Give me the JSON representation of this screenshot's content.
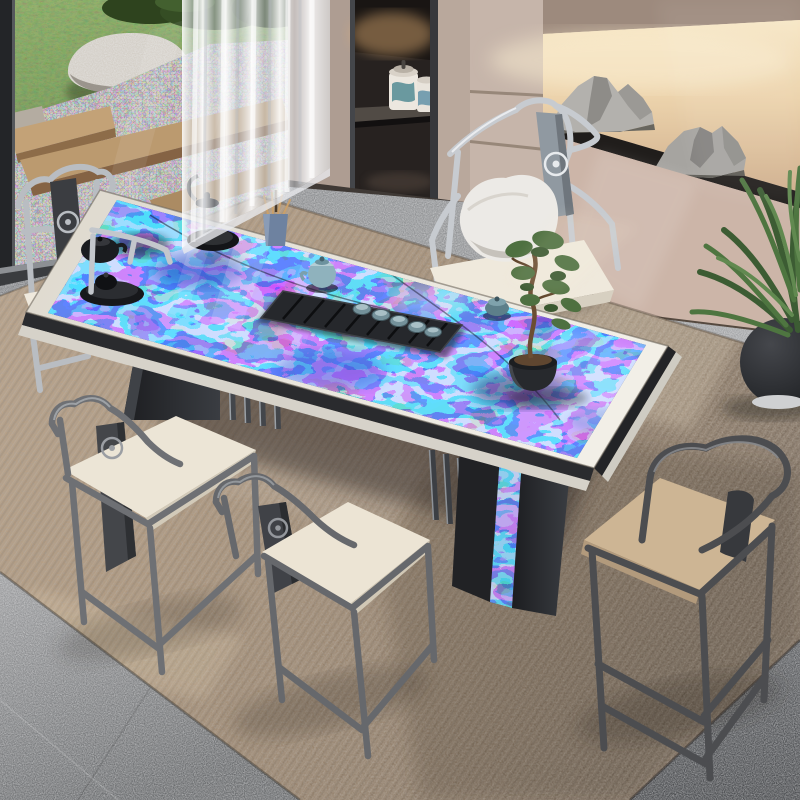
{
  "scene": {
    "title": "Sunlit modern Chinese tea room: labradorite blue-stone tea table with five gunmetal armchairs, sheer curtain, garden window, backlit rock niche and taupe cabinet",
    "window_garden": {
      "grass_color": "#6f8a4c",
      "boulder_color": "#cfc9c0",
      "gravel_color": "#97918b",
      "step_plank_color": "#bf9e74",
      "shrub_color": "#32481f"
    },
    "glazing_frame_color": "#222427",
    "curtain": {
      "type": "sheer-vertical-folds",
      "color": "#f4f5f7"
    },
    "cabinet": {
      "body_color": "#b7a69a",
      "niche_color": "#292320",
      "accent_light_color": "#e7b377",
      "tea_caddies": [
        {
          "body": "#ece7df",
          "motif": "#3f7f8a"
        },
        {
          "body": "#e9e4dc",
          "motif": "#46829c"
        }
      ]
    },
    "stone_niche": {
      "backlight_color": "#f3e0bf",
      "shelf_color": "#1f1d1b",
      "rock_sculpture_color": "#a8a6a2",
      "wall_color": "#c9b2a5"
    },
    "floor": {
      "tile_color": "#8e9092",
      "tile_shadow_color": "#5c5e60",
      "carpet_color": "#b09a80",
      "carpet_shadow_color": "#7e6f60"
    },
    "plant": {
      "foliage_color": "#44643a",
      "pot_color": "#26282b"
    },
    "table": {
      "top_material": "blue labradorite stone",
      "stone_colors": [
        "#2c4bb4",
        "#7d95d8",
        "#1b2550",
        "#9aa2b4",
        "#e2e6ee",
        "#15171b",
        "#b98f4a"
      ],
      "band_color": "#e8e4db",
      "apron_color": "#27282b",
      "leg_color": "#232428",
      "leg_detail": "vertical slat screen + labradorite edge inlay"
    },
    "tea_set": {
      "tray_color": "#202225",
      "tray_teapot_color": "#8fb2bd",
      "cup_color": "#74919a",
      "kettle_glass_color": "#d8dee3",
      "kettle_lid_color": "#0f1114",
      "stove_color": "#17191c",
      "black_teapot_color": "#1a1c1f",
      "gaiwan_color": "#5d7f8a",
      "tool_vase_color": "#6e82a0",
      "bonsai_pot_color": "#27292d",
      "bonsai_foliage_color": "#4e7040"
    },
    "chairs": [
      {
        "id": "back-left",
        "frame": "#b9bdc2",
        "cushion": "#efe9dd"
      },
      {
        "id": "back-center",
        "frame": "#c7cbd0",
        "cushion": "#efe9dc",
        "pillow": "#eceae6"
      },
      {
        "id": "front-left",
        "frame": "#6e7074",
        "cushion": "#ece5d6"
      },
      {
        "id": "front-center",
        "frame": "#66686c",
        "cushion": "#ece4d4"
      },
      {
        "id": "front-right",
        "frame": "#4c4d50",
        "cushion": "#cdb594"
      }
    ],
    "lighting": {
      "sun": "warm sunlight from upper left",
      "shadows": "soft diagonal shadows to lower right"
    }
  }
}
